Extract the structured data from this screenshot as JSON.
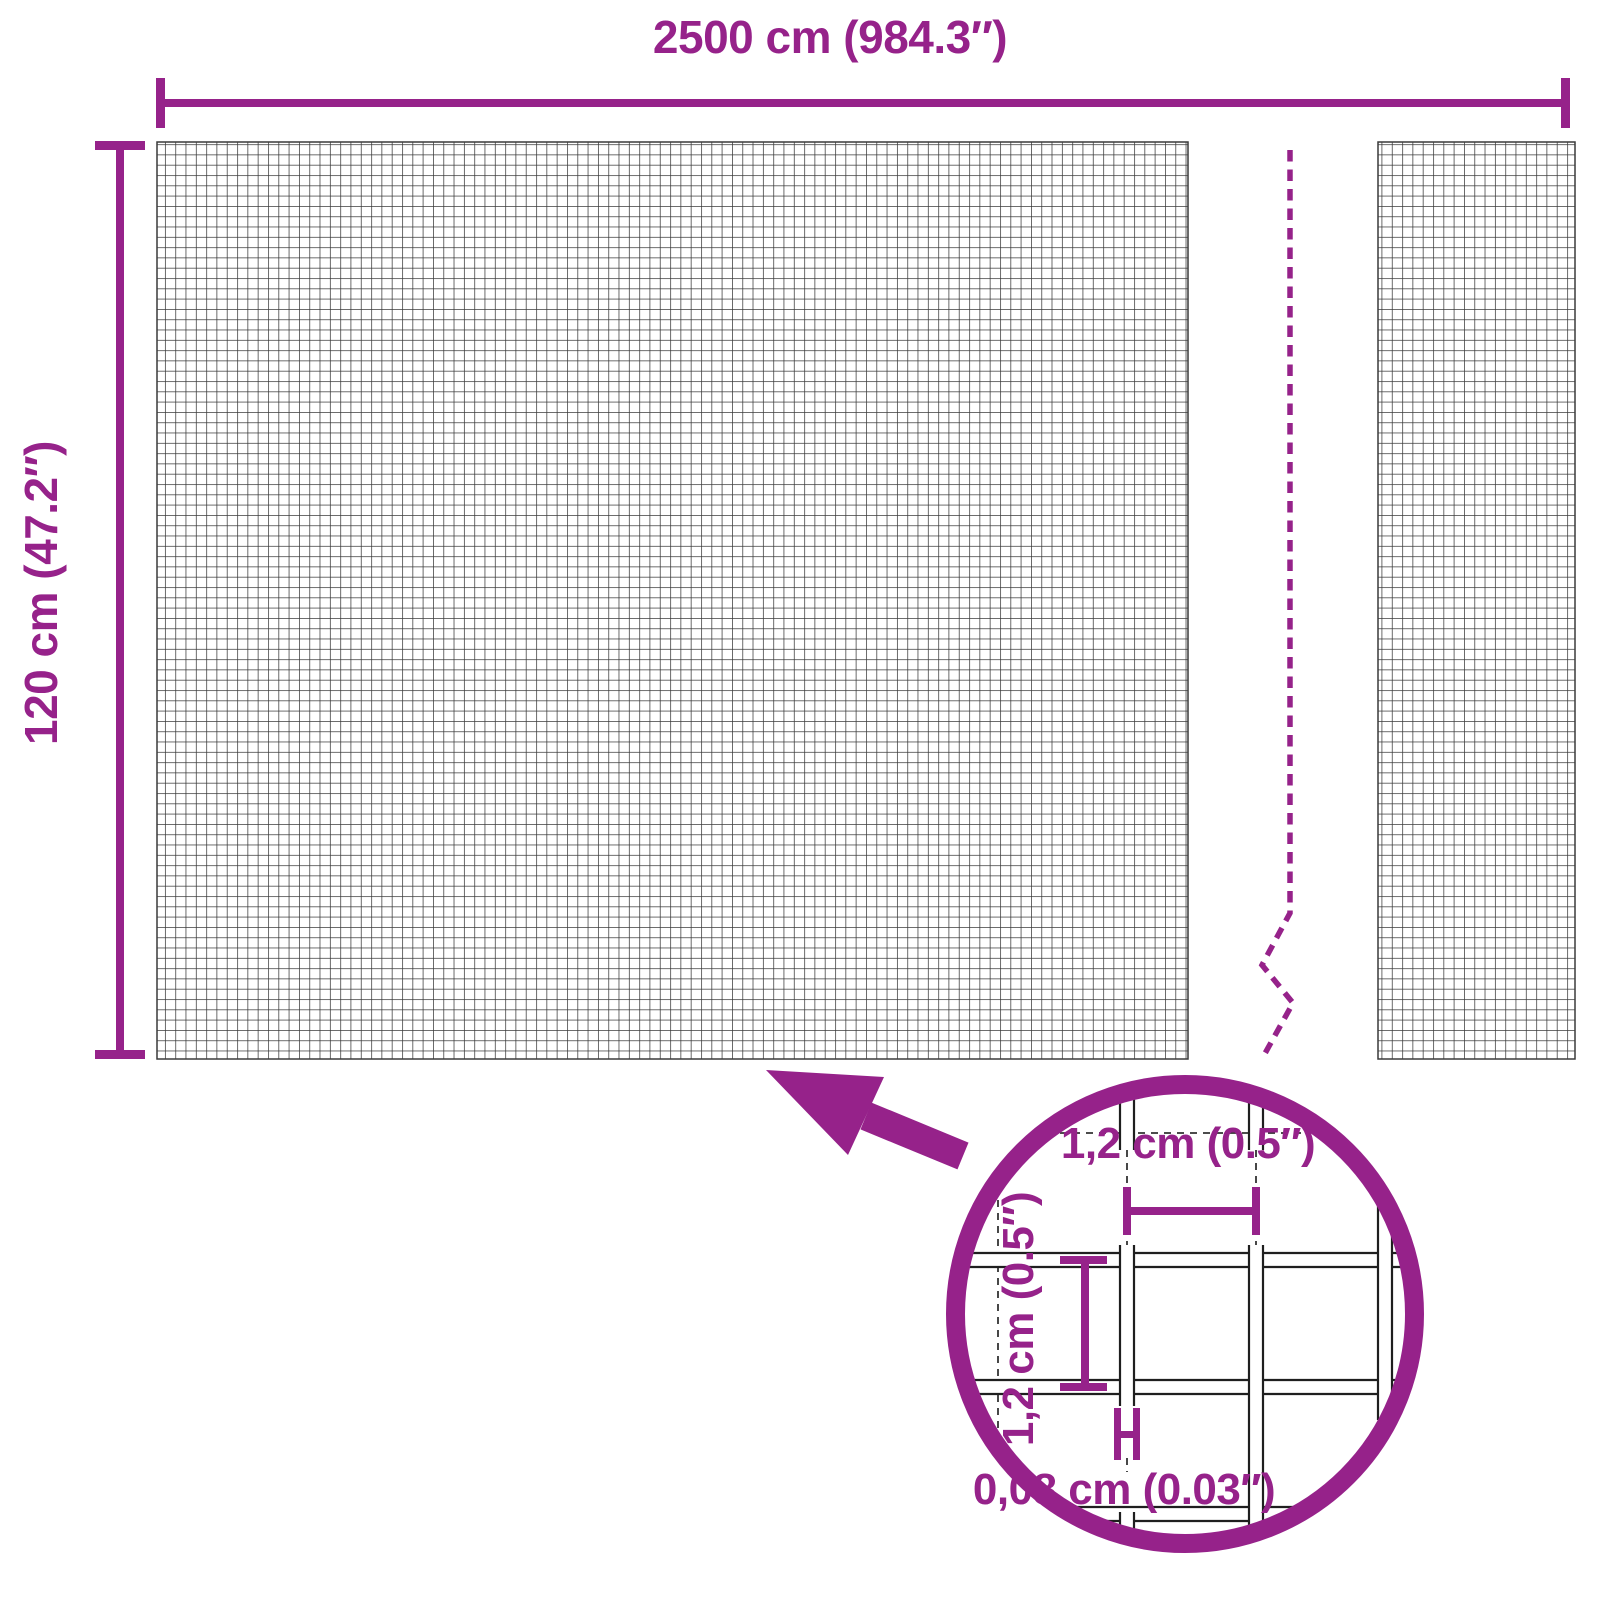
{
  "diagram": {
    "overall": {
      "width_label": "2500 cm (984.3″)",
      "height_label": "120 cm (47.2″)"
    },
    "detail": {
      "cell_width_label": "1,2 cm (0.5″)",
      "cell_height_label": "1,2 cm (0.5″)",
      "wire_thickness_label": "0,08 cm (0.03″)"
    },
    "colors": {
      "accent": "#96228A",
      "mesh_line": "#3a3a3a",
      "wire_outline": "#1f1f1f",
      "background": "#ffffff"
    },
    "icons": {
      "zoom_arrow": "arrow-pointing-up-left",
      "detail_circle": "magnifier-detail-circle",
      "break_line": "dashed-break-line"
    }
  }
}
